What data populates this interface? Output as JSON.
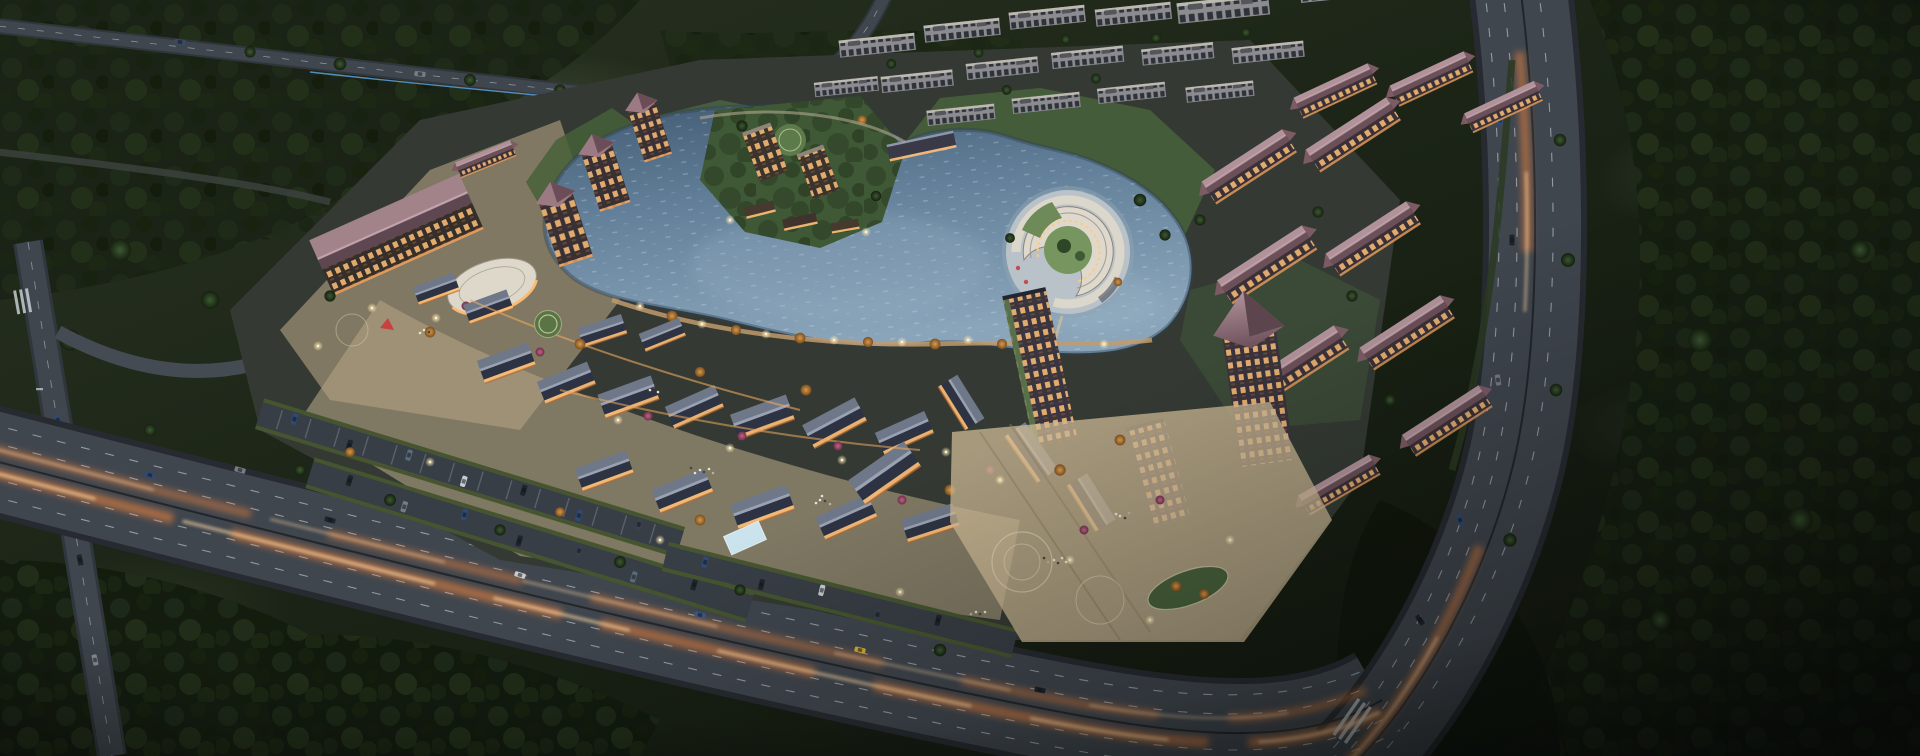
{
  "meta": {
    "content_type": "architectural-aerial-rendering",
    "time_of_day": "dusk",
    "visible_text": "none"
  },
  "palette": {
    "land_base": "#1b2416",
    "land_dark": "#11160d",
    "field_light": "#4d5840",
    "forest_canopy": "#1d2817",
    "road_asphalt": "#40464e",
    "road_curb": "#272b31",
    "lane_marking": "#ccd3d9",
    "trail_glow": "#ff8a3c",
    "trail_core": "#ffd9a6",
    "water_deep": "#445c74",
    "water_mid": "#64819b",
    "water_light": "#8aa5ba",
    "water_sparkle": "#dfeaf2",
    "roof_pink_light": "#b2929a",
    "roof_pink_dark": "#6b4f59",
    "roof_slate_light": "#6f7889",
    "roof_slate_dark": "#2d3342",
    "facade_dark": "#3a3138",
    "facade_gray": "#8b8b90",
    "window_warm": "#ffc178",
    "window_cool": "#232930",
    "lawn": "#46603a",
    "paving_warm": "#c0ab88",
    "plaza_light": "#cdb996",
    "tree_green": "#2e4527",
    "tree_autumn": "#c2833c",
    "tree_blossom": "#a84a6e",
    "lamp_glow": "#ffe9b8",
    "fence_blue": "#5da0d8",
    "pool_blue": "#cfe9f4"
  },
  "scene": {
    "regions": [
      {
        "name": "surrounding-forest",
        "description": "dense dark tree cover and fields framing the whole site"
      },
      {
        "name": "central-lake",
        "description": "irregular lake with sparkling blue-grey water at the heart of the development"
      },
      {
        "name": "spiral-waterfront-building",
        "description": "crescent/spiral terraced building on a round island in the east half of the lake"
      },
      {
        "name": "lake-island-cluster",
        "description": "two mid-rise towers and lit pavilions on a green island in the west half of the lake"
      },
      {
        "name": "north-residential-towers",
        "description": "rows of grey high-rise apartment slabs behind the lake"
      },
      {
        "name": "east-residential-slabs",
        "description": "mid-rise blocks with mauve hip roofs and warm lit windows east of the lake"
      },
      {
        "name": "west-hotel-cluster",
        "description": "hotel slab with mauve roof, oval pavilion and stepped towers on the west side"
      },
      {
        "name": "retail-village",
        "description": "low gabled shop buildings with slate roofs and glowing facades along the south shore"
      },
      {
        "name": "surface-parking",
        "description": "hedge-lined parking rows with cars between the village and the arterial road"
      },
      {
        "name": "east-plaza",
        "description": "large light-paved pedestrian plaza with oval lawn, trees and crowds"
      },
      {
        "name": "perimeter-arterial",
        "description": "wide arterial road sweeping around the south and east with warm car light trails"
      },
      {
        "name": "north-road",
        "description": "tree-lined road with blue construction fence along the north edge of the site"
      },
      {
        "name": "west-street",
        "description": "small street and intersection with crosswalk at the far west edge"
      }
    ]
  }
}
